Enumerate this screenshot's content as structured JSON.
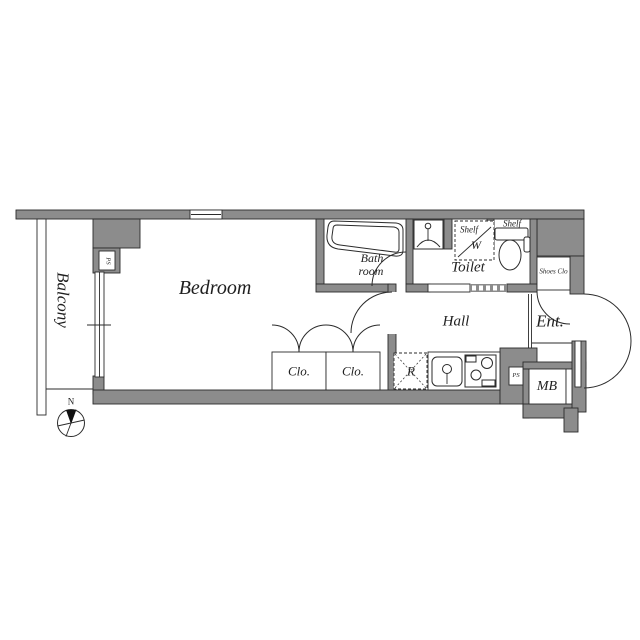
{
  "colors": {
    "wall": "#8c8c8c",
    "line": "#2b2b2b",
    "floor": "#ffffff"
  },
  "rooms": {
    "balcony": "Balcony",
    "bedroom": "Bedroom",
    "bath_line1": "Bath",
    "bath_line2": "room",
    "toilet": "Toilet",
    "hall": "Hall",
    "entrance": "Ent.",
    "closet1": "Clo.",
    "closet2": "Clo.",
    "shoes_closet": "Shoes Clo",
    "meter_box": "MB"
  },
  "fixtures": {
    "shelf_over_washer": "Shelf",
    "washer_letter": "W",
    "shelf_over_toilet": "Shelf",
    "refrigerator": "R",
    "pipe_space_top": "PS",
    "pipe_space_bottom": "PS"
  },
  "compass": {
    "north": "N"
  }
}
